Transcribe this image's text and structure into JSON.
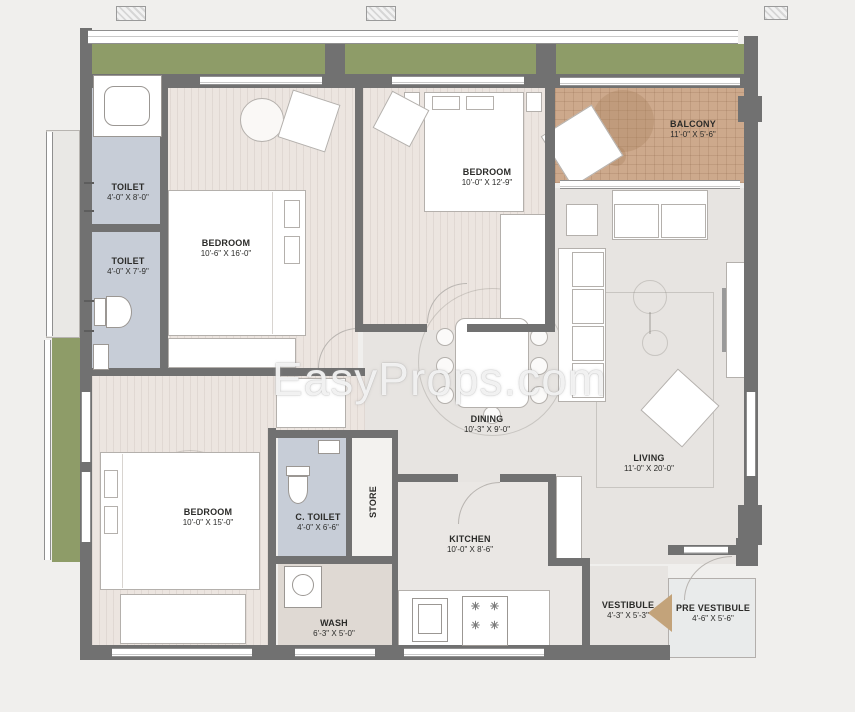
{
  "watermark": {
    "text": "EasyProps.com"
  },
  "rooms": {
    "toilet_top": {
      "name": "TOILET",
      "dims": "4'-0\" X 8'-0\""
    },
    "toilet_mid": {
      "name": "TOILET",
      "dims": "4'-0\" X 7'-9\""
    },
    "bedroom_top_left": {
      "name": "BEDROOM",
      "dims": "10'-6\" X 16'-0\""
    },
    "bedroom_top_mid": {
      "name": "BEDROOM",
      "dims": "10'-0\" X 12'-9\""
    },
    "balcony": {
      "name": "BALCONY",
      "dims": "11'-0\" X 5'-6\""
    },
    "dining": {
      "name": "DINING",
      "dims": "10'-3\" X 9'-0\""
    },
    "living": {
      "name": "LIVING",
      "dims": "11'-0\" X 20'-0\""
    },
    "bedroom_bottom_left": {
      "name": "BEDROOM",
      "dims": "10'-0\" X 15'-0\""
    },
    "c_toilet": {
      "name": "C. TOILET",
      "dims": "4'-0\" X 6'-6\""
    },
    "store": {
      "name": "STORE"
    },
    "kitchen": {
      "name": "KITCHEN",
      "dims": "10'-0\" X 8'-6\""
    },
    "wash": {
      "name": "WASH",
      "dims": "6'-3\" X 5'-0\""
    },
    "vestibule": {
      "name": "VESTIBULE",
      "dims": "4'-3\" X 5'-3\""
    },
    "pre_vestibule": {
      "name": "PRE VESTIBULE",
      "dims": "4'-6\" X 5'-6\""
    }
  },
  "icons": {
    "burner": "✳"
  },
  "colors": {
    "background": "#f0efed",
    "wall": "#717171",
    "planter_green": "#8e9c68",
    "balcony_tile": "#cda98c",
    "toilet_floor": "#c7cdd7",
    "wood_floor": "#ece5e0",
    "hall_floor": "#e7e4e1",
    "wash_floor": "#dfd9d3",
    "entry_arrow": "#c3a37a",
    "label_text": "#2b2b29",
    "watermark_text": "#ffffff"
  }
}
